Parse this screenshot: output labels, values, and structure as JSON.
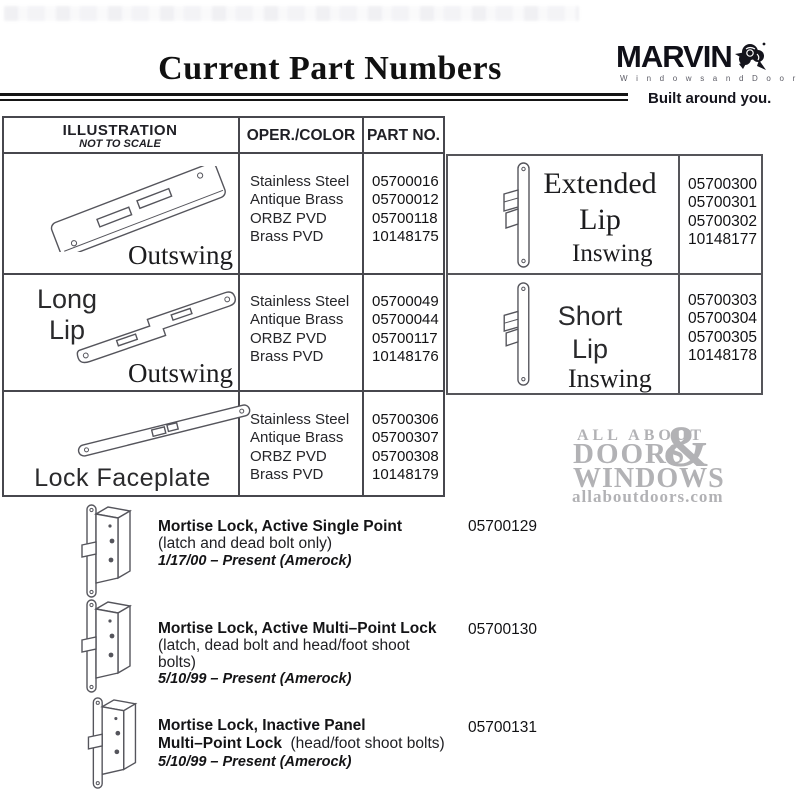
{
  "header": {
    "title": "Current Part Numbers",
    "brand_name": "MARVIN",
    "brand_sub": "W i n d o w s   a n d   D o o r s",
    "brand_tagline": "Built around you."
  },
  "left_table": {
    "col_illustration": "ILLUSTRATION",
    "col_illustration_sub": "NOT TO SCALE",
    "col_oper": "OPER./COLOR",
    "col_part": "PART NO.",
    "rows": [
      {
        "swing": "Outswing",
        "colors": [
          "Stainless Steel",
          "Antique Brass",
          "ORBZ PVD",
          "Brass PVD"
        ],
        "parts": [
          "05700016",
          "05700012",
          "05700118",
          "10148175"
        ]
      },
      {
        "name_line1": "Long",
        "name_line2": "Lip",
        "swing": "Outswing",
        "colors": [
          "Stainless Steel",
          "Antique Brass",
          "ORBZ PVD",
          "Brass PVD"
        ],
        "parts": [
          "05700049",
          "05700044",
          "05700117",
          "10148176"
        ]
      },
      {
        "name": "Lock Faceplate",
        "colors": [
          "Stainless Steel",
          "Antique Brass",
          "ORBZ PVD",
          "Brass PVD"
        ],
        "parts": [
          "05700306",
          "05700307",
          "05700308",
          "10148179"
        ]
      }
    ]
  },
  "right_table": {
    "rows": [
      {
        "name_line1": "Extended",
        "name_line2": "Lip",
        "swing": "Inswing",
        "parts": [
          "05700300",
          "05700301",
          "05700302",
          "10148177"
        ]
      },
      {
        "name_line1": "Short",
        "name_line2": "Lip",
        "swing": "Inswing",
        "parts": [
          "05700303",
          "05700304",
          "05700305",
          "10148178"
        ]
      }
    ]
  },
  "watermark": {
    "line1": "ALL ABOUT",
    "ampersand": "&",
    "line2": "DOORS",
    "line3": "WINDOWS",
    "url": "allaboutdoors.com"
  },
  "catalog_items": [
    {
      "title": "Mortise Lock, Active Single Point",
      "desc": "(latch and dead bolt only)",
      "date": "1/17/00 – Present (Amerock)",
      "part": "05700129"
    },
    {
      "title": "Mortise Lock, Active Multi–Point Lock",
      "desc": "(latch, dead bolt and head/foot shoot",
      "desc2": "bolts)",
      "date": "5/10/99 – Present (Amerock)",
      "part": "05700130"
    },
    {
      "title": "Mortise Lock, Inactive  Panel",
      "title2": "Multi–Point Lock",
      "desc_inline": "(head/foot shoot bolts)",
      "date": "5/10/99 – Present  (Amerock)",
      "part": "05700131"
    }
  ]
}
